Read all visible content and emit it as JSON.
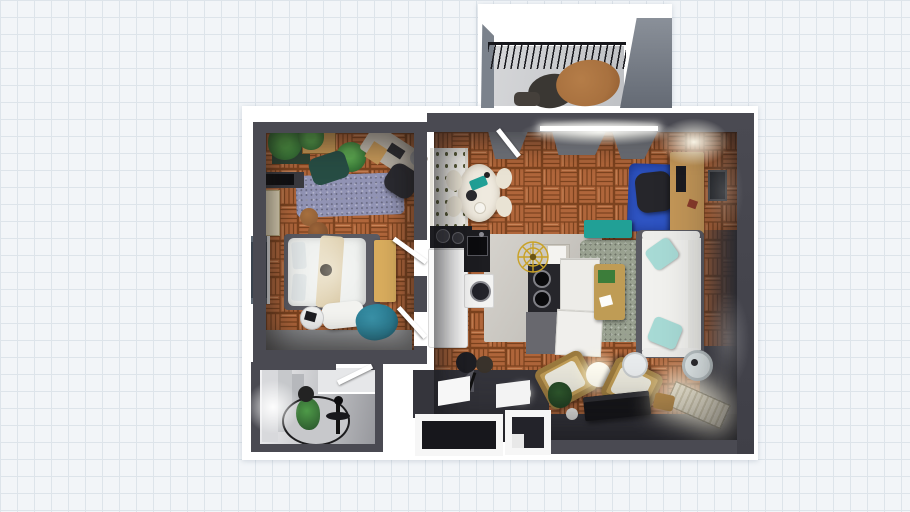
{
  "app": {
    "name": "floorplan-3d-top-view",
    "canvas_background": "grid-paper"
  },
  "palette": {
    "grid_bg": "#f2f5f8",
    "grid_line": "#dde4ea",
    "sheet": "#ffffff",
    "wall": "#4a4a52",
    "wall_lit": "#8e9096",
    "wall_balcony": "#7b828c",
    "parquet": "#b0663b",
    "parquet_line": "#7c431f",
    "parquet_hi": "#d08a54",
    "kitchen_floor": "#c8c5bf",
    "bathroom_floor": "#c9cacd",
    "balcony_floor": "#d6d7d9",
    "entry_floor": "#35353c",
    "rug_bedroom": "#9193b4",
    "rug_living": "#99a190",
    "rug_office": "#2f55c4",
    "runner_gray": "#8b8d90",
    "bed_linen": "#eef0ee",
    "throw_cream": "#e8dcc0",
    "bench_wood": "#d8ac5d",
    "desk_wood": "#c49758",
    "armchair_wood": "#bf9c55",
    "cushion_cream": "#eae8dc",
    "sofa_fabric": "#f1f1ee",
    "sofa_frame": "#5a5a62",
    "pillow_teal": "#a7dad5",
    "bean_bag_teal": "#2b7d93",
    "accent_teal": "#21a096",
    "dining_cream": "#efeadf",
    "fridge_white": "#fafafa",
    "counter_black": "#1d1d21",
    "cabinet_gray": "#68686e",
    "tv_black": "#141417",
    "plant_green": "#3c7d3a",
    "plant_dark": "#27512a",
    "planter_dark": "#2c4435",
    "pouf_brown": "#8a5a34",
    "balcony_table": "#a8713f",
    "seat_dark": "#3a3733",
    "window_glass": "#39434e",
    "lamp_glow": "#fff8dd",
    "gold": "#c9a227"
  },
  "scene": {
    "type": "apartment-floor-plan-render",
    "rooms": [
      {
        "id": "balcony",
        "items": [
          "railing",
          "oval-table",
          "lounge-seat",
          "floor-cushion"
        ]
      },
      {
        "id": "bedroom",
        "floor": "parquet",
        "items": [
          "palm-planter",
          "wood-crate",
          "potted-bush",
          "accent-chair",
          "shag-rug",
          "desk",
          "office-chair",
          "tv-shelf",
          "cream-cabinet",
          "poufs",
          "window",
          "double-bed",
          "pillows",
          "throw-blanket",
          "foot-bench",
          "ottoman",
          "side-table",
          "bean-bag",
          "runner-rug",
          "door-leaves"
        ]
      },
      {
        "id": "living-kitchen",
        "floor": "parquet",
        "items": [
          "curtains",
          "window-strip",
          "balcony-door",
          "plant-shelf",
          "dining-table",
          "dining-chairs",
          "stove-counter",
          "pendant-chandelier",
          "fridge",
          "sink-counter",
          "washing-machine",
          "upper-cabinet",
          "cooktop-island",
          "island-cabinets",
          "drawer-unit",
          "area-rug",
          "coffee-table",
          "sofa",
          "throw-pillows",
          "office-rug",
          "office-chair",
          "office-desk",
          "wall-lamp",
          "picture-frame",
          "tv-bench-teal",
          "floor-lamp-black",
          "floor-lamp-globe",
          "sphere-lamp",
          "armchair-left",
          "armchair-right",
          "planter",
          "tv-console",
          "radiator",
          "drum-lamp",
          "stool"
        ]
      },
      {
        "id": "bathroom",
        "items": [
          "wall-lamp-glow",
          "interior-partitions",
          "vanity",
          "round-rug",
          "plant",
          "fan-floor-lamp",
          "wall-disc",
          "door-leaf"
        ]
      },
      {
        "id": "entry",
        "items": [
          "platform",
          "door-leaf-left",
          "door-leaf-right",
          "door-frame-left",
          "door-frame-right"
        ]
      }
    ]
  }
}
